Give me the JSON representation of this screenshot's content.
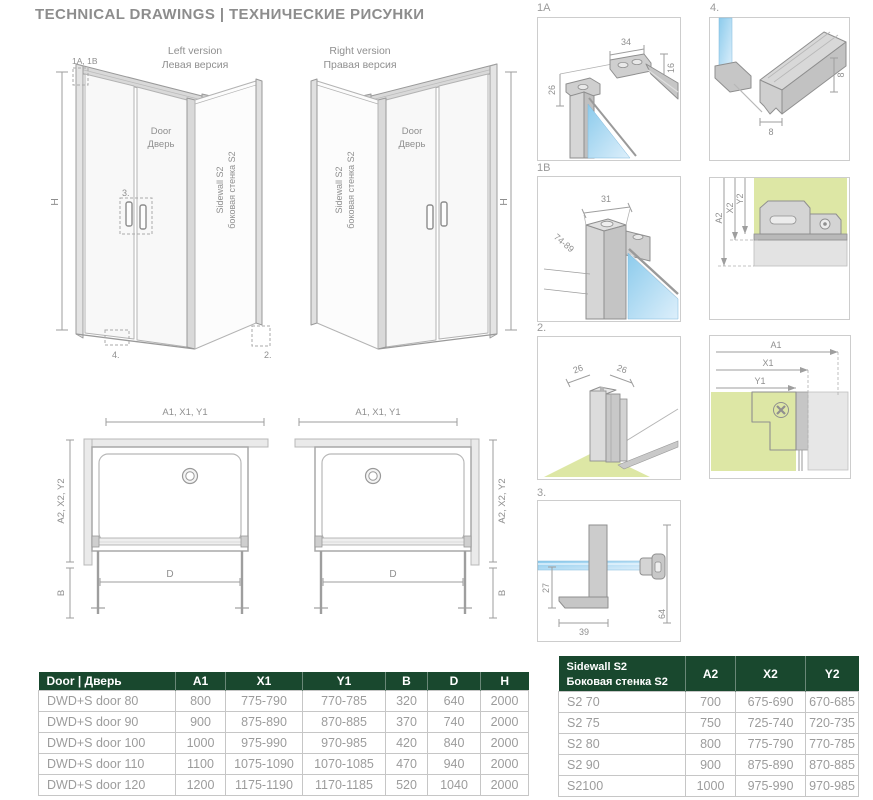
{
  "title": "TECHNICAL DRAWINGS  |  ТЕХНИЧЕСКИЕ РИСУНКИ",
  "colors": {
    "header_green": "#19482e",
    "glass_blue": "#a9d7f2",
    "wall_green": "#dde7a5",
    "line_gray": "#9a9a9a"
  },
  "drawings": {
    "left3d": {
      "title1": "Left version",
      "title2": "Левая версия",
      "door1": "Door",
      "door2": "Дверь",
      "side1": "Sidewall S2",
      "side2": "боковая стенка S2",
      "h": "H",
      "c_top": "1A, 1B",
      "c_handle": "3.",
      "c_bottom": "4.",
      "c_side": "2."
    },
    "right3d": {
      "title1": "Right version",
      "title2": "Правая версия",
      "door1": "Door",
      "door2": "Дверь",
      "side1": "Sidewall S2",
      "side2": "боковая стенка S2",
      "h": "H"
    },
    "top_left": {
      "w": "A1, X1, Y1",
      "d": "A2, X2, Y2",
      "b": "B",
      "door": "D"
    },
    "top_right": {
      "w": "A1, X1, Y1",
      "d": "A2, X2, Y2",
      "b": "B",
      "door": "D"
    }
  },
  "details": {
    "d1a": {
      "label": "1A",
      "dim_top": "34",
      "dim_right": "16",
      "dim_left": "26"
    },
    "d4": {
      "label": "4.",
      "dim_w": "8",
      "dim_h": "8"
    },
    "d1b": {
      "label": "1B",
      "dim_top": "31",
      "dim_range": "74-89"
    },
    "da2": {
      "a2": "A2",
      "x2": "X2",
      "y2": "Y2"
    },
    "d2": {
      "label": "2.",
      "dim_l": "26",
      "dim_r": "26"
    },
    "da1": {
      "a1": "A1",
      "x1": "X1",
      "y1": "Y1"
    },
    "d3": {
      "label": "3.",
      "dim_l": "27",
      "dim_b": "39",
      "dim_r": "64"
    }
  },
  "tables": {
    "door": {
      "header": [
        "Door | Дверь",
        "A1",
        "X1",
        "Y1",
        "B",
        "D",
        "H"
      ],
      "rows": [
        [
          "DWD+S door 80",
          "800",
          "775-790",
          "770-785",
          "320",
          "640",
          "2000"
        ],
        [
          "DWD+S door 90",
          "900",
          "875-890",
          "870-885",
          "370",
          "740",
          "2000"
        ],
        [
          "DWD+S door 100",
          "1000",
          "975-990",
          "970-985",
          "420",
          "840",
          "2000"
        ],
        [
          "DWD+S door 110",
          "1100",
          "1075-1090",
          "1070-1085",
          "470",
          "940",
          "2000"
        ],
        [
          "DWD+S door 120",
          "1200",
          "1175-1190",
          "1170-1185",
          "520",
          "1040",
          "2000"
        ]
      ]
    },
    "sidewall": {
      "header_line1": "Sidewall S2",
      "header_line2": "Боковая стенка S2",
      "header": [
        "A2",
        "X2",
        "Y2"
      ],
      "rows": [
        [
          "S2 70",
          "700",
          "675-690",
          "670-685"
        ],
        [
          "S2 75",
          "750",
          "725-740",
          "720-735"
        ],
        [
          "S2 80",
          "800",
          "775-790",
          "770-785"
        ],
        [
          "S2 90",
          "900",
          "875-890",
          "870-885"
        ],
        [
          "S2100",
          "1000",
          "975-990",
          "970-985"
        ]
      ]
    }
  }
}
